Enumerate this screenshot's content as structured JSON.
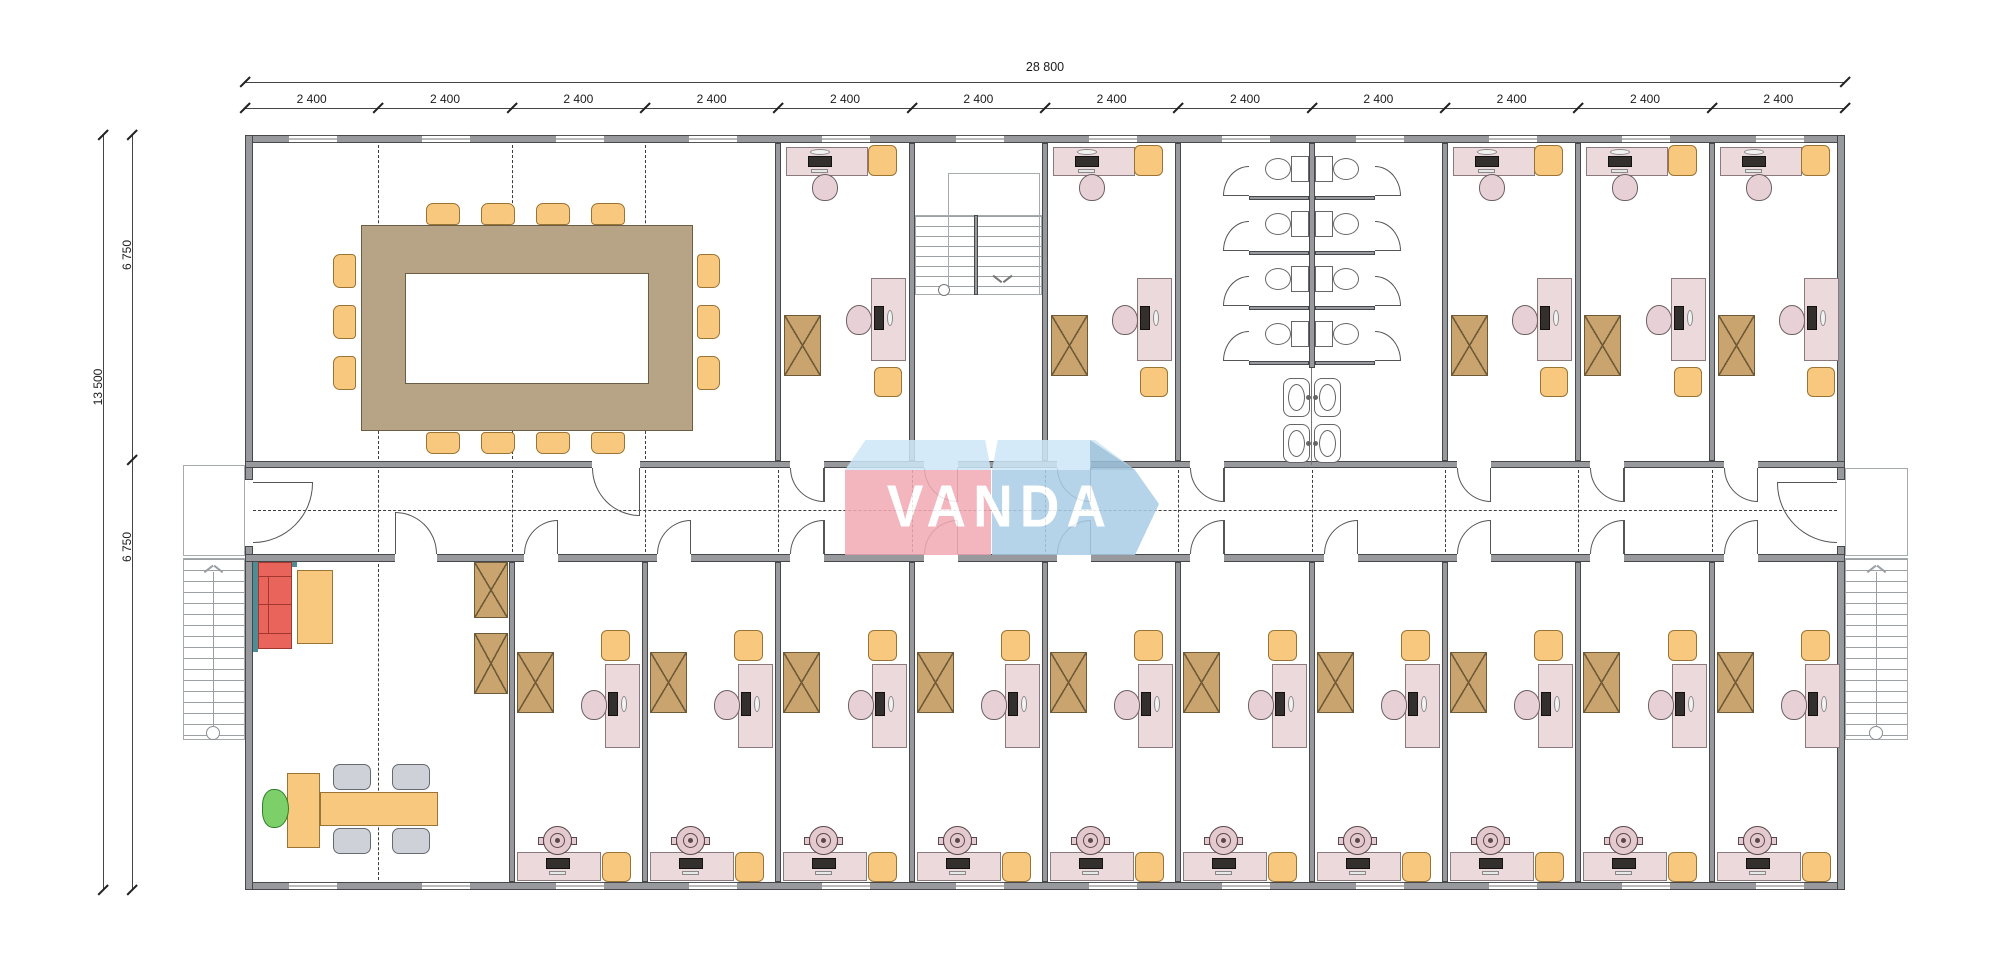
{
  "page": {
    "title": "Office building floor plan",
    "background": "#ffffff"
  },
  "dimensions": {
    "total_width_label": "28 800",
    "bay_labels": [
      "2 400",
      "2 400",
      "2 400",
      "2 400",
      "2 400",
      "2 400",
      "2 400",
      "2 400",
      "2 400",
      "2 400",
      "2 400",
      "2 400"
    ],
    "total_height_label": "13 500",
    "upper_height_label": "6 750",
    "lower_height_label": "6 750"
  },
  "logo": {
    "text": "VANDA",
    "red": "#f2a9b4",
    "blue": "#a9cde6",
    "light_blue": "#cde7f8",
    "fold": "#99bfd8",
    "text_color": "#ffffff"
  },
  "colors": {
    "wall": "#97999c",
    "wall_edge": "#46484b",
    "line": "#555555",
    "dash": "#3c3c3c",
    "desk_pink": "#ecd9dc",
    "desk_edge": "#8a797d",
    "chair_pink": "#e7d1d7",
    "chair_pink_edge": "#6d5f63",
    "orange": "#f8c87f",
    "orange_edge": "#9a7434",
    "cabinet": "#c9a46f",
    "cabinet_edge": "#6e5a36",
    "table_tan": "#b7a386",
    "table_edge": "#6b5e45",
    "sofa_red": "#e9655b",
    "sofa_edge": "#a03830",
    "green_chair": "#7dd069",
    "green_edge": "#2f7d2a",
    "gray_chair": "#ced2d8",
    "gray_edge": "#666b72",
    "teal": "#4f8d95",
    "stairs": "#9aa0a3",
    "monitor": "#332f2d",
    "pot": "#e4cacf",
    "pot_edge": "#5a474c",
    "fixture": "#666666"
  },
  "building": {
    "top_band": [
      {
        "type": "conference-room",
        "bays": 4
      },
      {
        "type": "office",
        "bays": 1
      },
      {
        "type": "stairwell",
        "bays": 1
      },
      {
        "type": "office",
        "bays": 1
      },
      {
        "type": "washroom",
        "bays": 2
      },
      {
        "type": "office",
        "bays": 1
      },
      {
        "type": "office",
        "bays": 1
      },
      {
        "type": "office",
        "bays": 1
      }
    ],
    "bottom_band": [
      {
        "type": "reception-lounge",
        "bays": 2
      },
      {
        "type": "office",
        "bays": 1
      },
      {
        "type": "office",
        "bays": 1
      },
      {
        "type": "office",
        "bays": 1
      },
      {
        "type": "office",
        "bays": 1
      },
      {
        "type": "office",
        "bays": 1
      },
      {
        "type": "office",
        "bays": 1
      },
      {
        "type": "office",
        "bays": 1
      },
      {
        "type": "office",
        "bays": 1
      },
      {
        "type": "office",
        "bays": 1
      },
      {
        "type": "office",
        "bays": 1
      }
    ],
    "conference_seats": {
      "top": 4,
      "bottom": 4,
      "left": 3,
      "right": 3
    },
    "washroom": {
      "stalls_per_side": 4,
      "sink_pairs": 2
    },
    "reception": {
      "visitor_chairs": 4,
      "sofa_seats": 2
    }
  }
}
